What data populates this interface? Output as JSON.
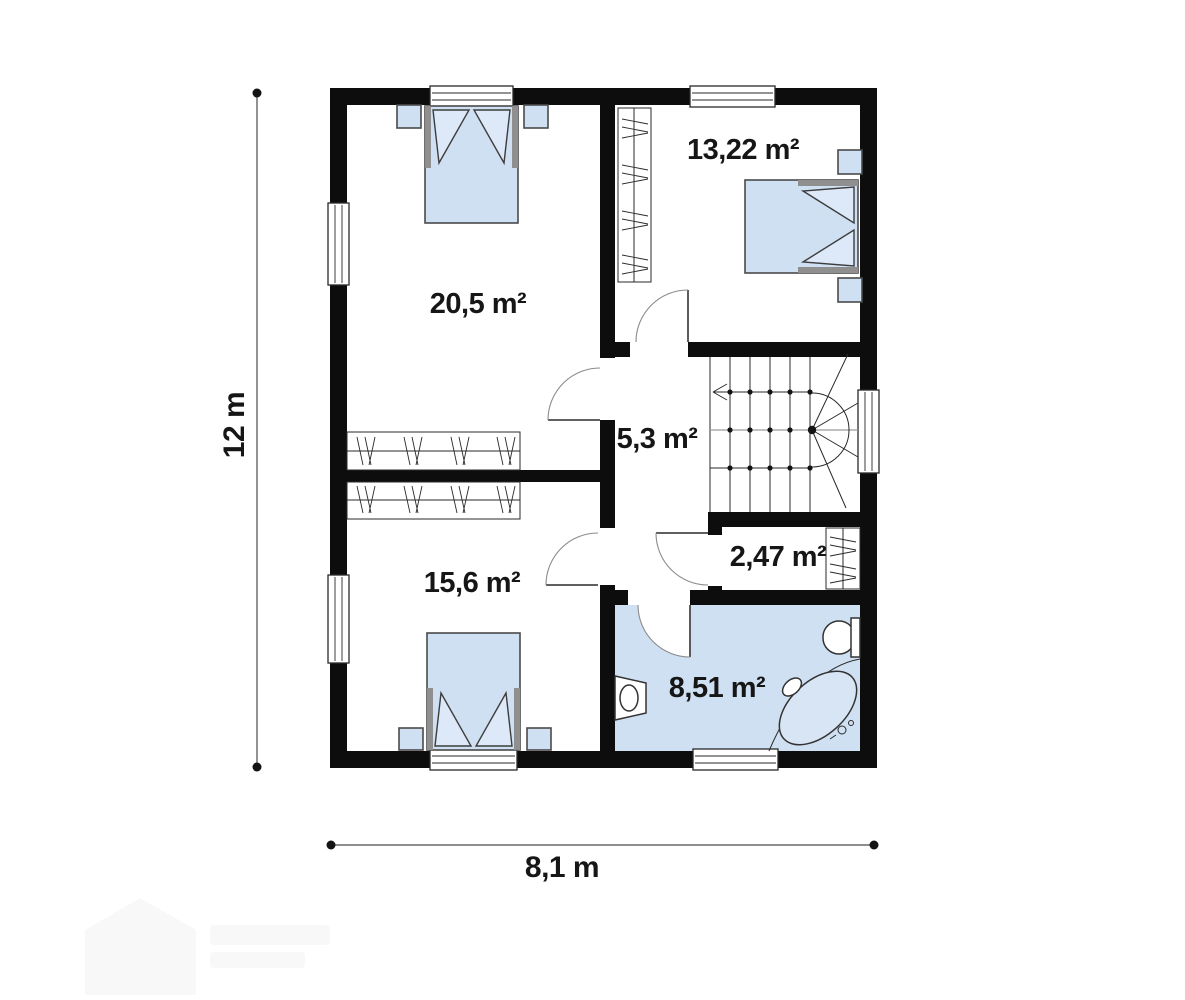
{
  "plan": {
    "type": "floor-plan",
    "rooms": [
      {
        "id": "bedroom-top-left",
        "area_label": "20,5 m²"
      },
      {
        "id": "bedroom-top-right",
        "area_label": "13,22 m²"
      },
      {
        "id": "hall-stairs",
        "area_label": "5,3 m²"
      },
      {
        "id": "closet",
        "area_label": "2,47 m²"
      },
      {
        "id": "bedroom-bottom-left",
        "area_label": "15,6 m²"
      },
      {
        "id": "bathroom",
        "area_label": "8,51 m²"
      }
    ],
    "dimensions": {
      "vertical_label": "12 m",
      "horizontal_label": "8,1 m"
    },
    "colors": {
      "wall": "#0d0d0d",
      "furn": "#cfe0f2",
      "ink": "#161616"
    }
  }
}
